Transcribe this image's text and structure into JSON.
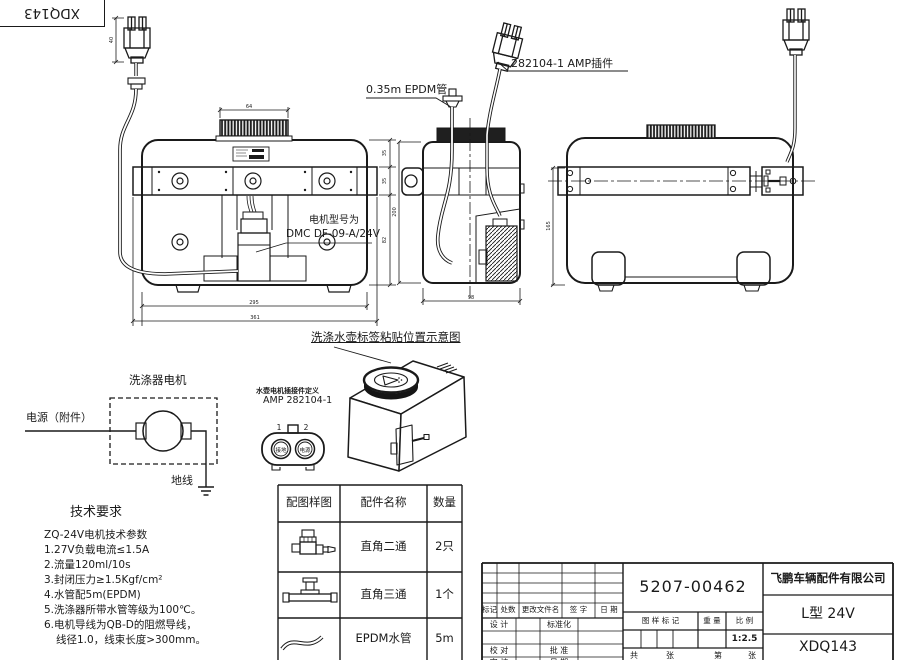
{
  "corner_stamp": "XDQ143",
  "callouts": {
    "epdm_tube": "0.35m EPDM管",
    "amp_plug": "282104-1  AMP插件",
    "motor_model_label": "电机型号为",
    "motor_model_value": "DMC DF-09-A/24V",
    "label_note": "洗涤水壶标签粘贴位置示意图"
  },
  "dims": {
    "cap": "64",
    "front_h_top": "35",
    "front_h_mid": "35",
    "front_h_bottom": "82",
    "front_width_inner": "295",
    "front_width_outer": "361",
    "side_width": "98",
    "side_height": "200",
    "rear_height": "165",
    "plug_height": "40"
  },
  "wiring": {
    "title": "洗涤器电机",
    "power": "电源（附件）",
    "ground": "地线"
  },
  "connector": {
    "note": "水壶电机插接件定义",
    "model": "AMP 282104-1",
    "pin1": "1",
    "pin2": "2",
    "pin1_label": "接地",
    "pin2_label": "电源"
  },
  "tech": {
    "title": "技术要求",
    "lines": [
      "ZQ-24V电机技术参数",
      "1.27V负载电流≤1.5A",
      "2.流量120ml/10s",
      "3.封闭压力≥1.5Kgf/cm²",
      "4.水管配5m(EPDM)",
      "5.洗涤器所带水管等级为100℃。",
      "6.电机导线为QB-D的阻燃导线，",
      "线径1.0，线束长度>300mm。"
    ]
  },
  "parts_table": {
    "headers": [
      "配图样图",
      "配件名称",
      "数量"
    ],
    "rows": [
      {
        "icon": "elbow-fitting-icon",
        "name": "直角二通",
        "qty": "2只"
      },
      {
        "icon": "tee-fitting-icon",
        "name": "直角三通",
        "qty": "1个"
      },
      {
        "icon": "hose-icon",
        "name": "EPDM水管",
        "qty": "5m"
      }
    ]
  },
  "title_block": {
    "part_number": "5207-00462",
    "company": "飞鹏车辆配件有限公司",
    "model": "L型 24V",
    "drawing_no": "XDQ143",
    "scale": "1:2.5",
    "rev_cols": [
      "标记",
      "处数",
      "更改文件名",
      "签 字",
      "日 期"
    ],
    "sig": {
      "design": "设 计",
      "standardize": "标准化",
      "check": "校 对",
      "approve": "批 准",
      "review": "审 核",
      "date": "日 期"
    },
    "headers": {
      "mark": "图 样 标 记",
      "weight": "重 量",
      "scale": "比 例"
    },
    "sheet": {
      "total": "共",
      "total_unit": "张",
      "page": "第",
      "page_unit": "张"
    }
  }
}
